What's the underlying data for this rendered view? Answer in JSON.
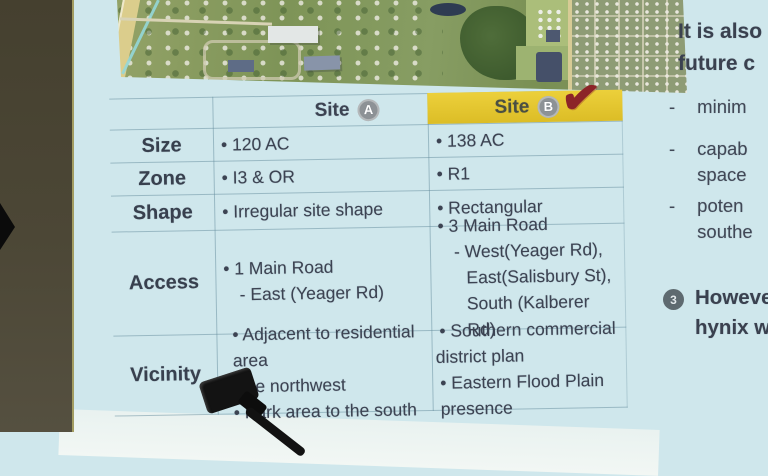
{
  "slide": {
    "colors": {
      "slide_blue": "#cfe7ec",
      "accent_yellow": "#e3c52e",
      "check_red": "#8c2428",
      "badge_gray": "#8d9296"
    },
    "table": {
      "check": "✔",
      "columns": [
        {
          "label": "Site",
          "badge": "A",
          "selected": false
        },
        {
          "label": "Site",
          "badge": "B",
          "selected": true
        }
      ],
      "rows": [
        {
          "label": "Size",
          "a": [
            "• 120 AC"
          ],
          "b": [
            "• 138 AC"
          ]
        },
        {
          "label": "Zone",
          "a": [
            "• I3 & OR"
          ],
          "b": [
            "• R1"
          ]
        },
        {
          "label": "Shape",
          "a": [
            "• Irregular site shape"
          ],
          "b": [
            "• Rectangular"
          ]
        },
        {
          "label": "Access",
          "a": [
            "• 1 Main Road",
            "- East (Yeager Rd)"
          ],
          "b": [
            "• 3 Main Road",
            "- West(Yeager Rd),",
            "East(Salisbury St),",
            "South (Kalberer Rd)"
          ]
        },
        {
          "label": "Vicinity",
          "a": [
            "• Adjacent to residential area",
            "to the northwest",
            "• Park area to the south"
          ],
          "b": [
            "• Southern commercial",
            "district plan",
            "• Eastern Flood Plain presence"
          ]
        }
      ]
    },
    "right_panel": {
      "heading": [
        "It is also",
        "future c"
      ],
      "bullets": [
        {
          "dash": "-",
          "lines": [
            "minim"
          ]
        },
        {
          "dash": "-",
          "lines": [
            "capab",
            "space"
          ]
        },
        {
          "dash": "-",
          "lines": [
            "poten",
            "southe"
          ]
        }
      ],
      "numbered": {
        "number": "3",
        "lines": [
          "However",
          "hynix wi"
        ]
      }
    }
  }
}
